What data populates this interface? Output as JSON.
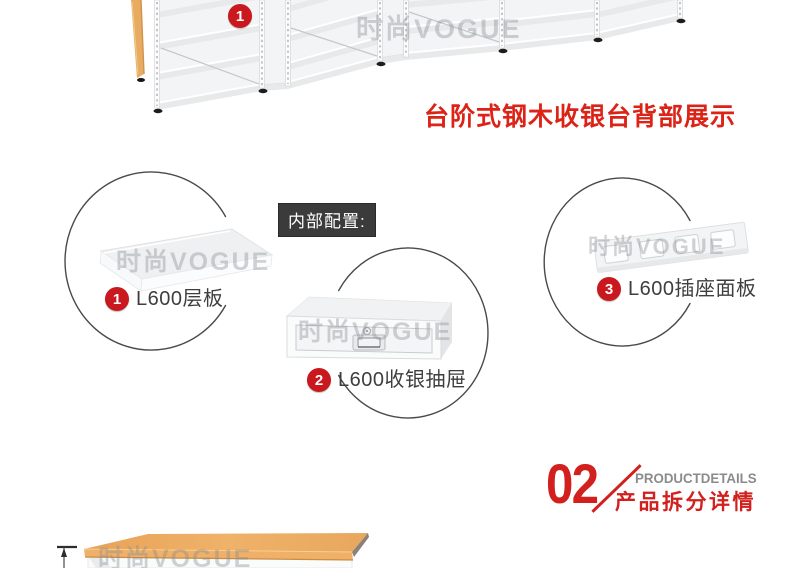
{
  "watermark": {
    "text": "时尚VOGUE"
  },
  "top_section": {
    "marker": "1",
    "caption": "台阶式钢木收银台背部展示"
  },
  "config_section": {
    "header": "内部配置:",
    "items": [
      {
        "num": "1",
        "label": "L600层板"
      },
      {
        "num": "2",
        "label": "L600收银抽屉"
      },
      {
        "num": "3",
        "label": "L600插座面板"
      }
    ]
  },
  "details_section": {
    "number": "02",
    "title_en": "PRODUCTDETAILS",
    "title_zh": "产品拆分详情"
  },
  "colors": {
    "accent_red": "#d2201e",
    "badge_red": "#c9181e",
    "caption_red": "#dc2318",
    "gray_text": "#8b8b8b",
    "label_box_bg": "#3b3b3b",
    "wood": "#ecab63"
  }
}
